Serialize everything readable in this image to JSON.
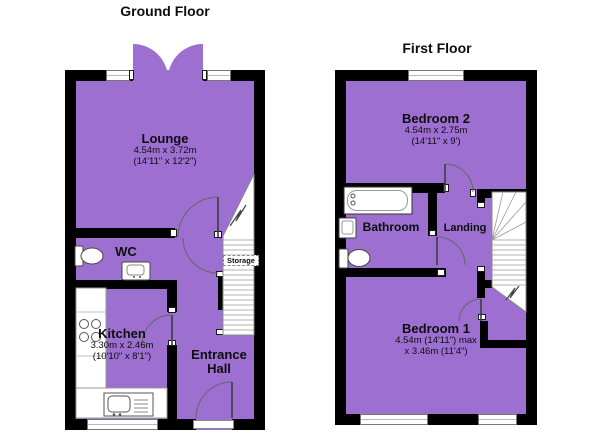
{
  "colors": {
    "room_fill": "#9c6fd1",
    "wall": "#000000",
    "background": "#ffffff"
  },
  "ground_floor": {
    "title": "Ground Floor",
    "rooms": {
      "lounge": {
        "name": "Lounge",
        "dims_metric": "4.54m x 3.72m",
        "dims_imperial": "(14'11\" x 12'2\")"
      },
      "wc": {
        "name": "WC"
      },
      "kitchen": {
        "name": "Kitchen",
        "dims_metric": "3.30m x 2.46m",
        "dims_imperial": "(10'10\" x 8'1\")"
      },
      "entrance_hall": {
        "name": "Entrance Hall"
      },
      "storage": {
        "name": "Storage"
      }
    }
  },
  "first_floor": {
    "title": "First Floor",
    "rooms": {
      "bedroom2": {
        "name": "Bedroom 2",
        "dims_metric": "4.54m x 2.75m",
        "dims_imperial": "(14'11\" x 9')"
      },
      "bathroom": {
        "name": "Bathroom"
      },
      "landing": {
        "name": "Landing"
      },
      "bedroom1": {
        "name": "Bedroom 1",
        "dims_line1": "4.54m (14'11\") max",
        "dims_line2": "x 3.46m (11'4\")"
      }
    }
  }
}
